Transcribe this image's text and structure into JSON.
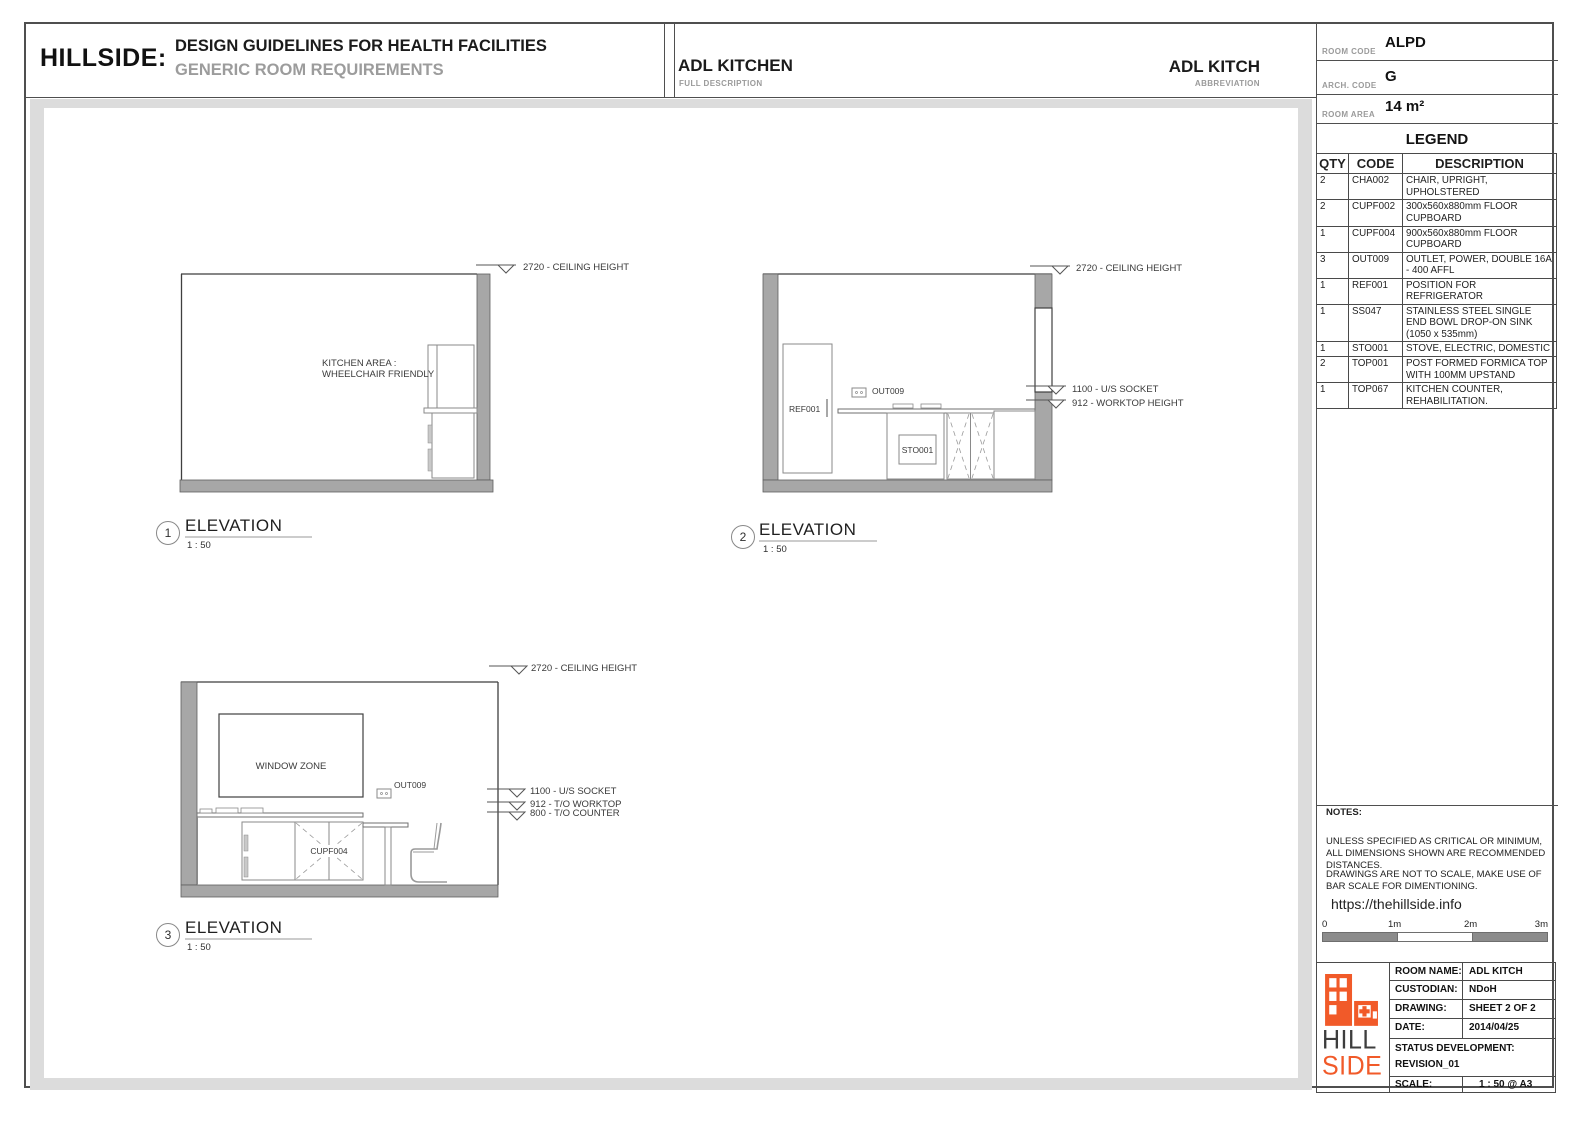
{
  "header": {
    "brand": "HILLSIDE:",
    "title": "DESIGN GUIDELINES FOR HEALTH FACILITIES",
    "subtitle": "GENERIC ROOM REQUIREMENTS",
    "full_description": {
      "value": "ADL KITCHEN",
      "label": "FULL DESCRIPTION"
    },
    "abbreviation": {
      "value": "ADL KITCH",
      "label": "ABBREVIATION"
    }
  },
  "info_panel": {
    "room_code": {
      "label": "ROOM CODE",
      "value": "ALPD"
    },
    "arch_code": {
      "label": "ARCH. CODE",
      "value": "G"
    },
    "room_area": {
      "label": "ROOM AREA",
      "value": "14 m²"
    }
  },
  "legend": {
    "title": "LEGEND",
    "columns": [
      "QTY",
      "CODE",
      "DESCRIPTION"
    ],
    "rows": [
      {
        "qty": "2",
        "code": "CHA002",
        "description": "CHAIR, UPRIGHT, UPHOLSTERED"
      },
      {
        "qty": "2",
        "code": "CUPF002",
        "description": "300x560x880mm FLOOR CUPBOARD"
      },
      {
        "qty": "1",
        "code": "CUPF004",
        "description": "900x560x880mm FLOOR CUPBOARD"
      },
      {
        "qty": "3",
        "code": "OUT009",
        "description": "OUTLET, POWER, DOUBLE 16A - 400 AFFL"
      },
      {
        "qty": "1",
        "code": "REF001",
        "description": "POSITION FOR REFRIGERATOR"
      },
      {
        "qty": "1",
        "code": "SS047",
        "description": "STAINLESS STEEL SINGLE END BOWL  DROP-ON SINK (1050 x 535mm)"
      },
      {
        "qty": "1",
        "code": "STO001",
        "description": "STOVE, ELECTRIC, DOMESTIC"
      },
      {
        "qty": "2",
        "code": "TOP001",
        "description": "POST FORMED FORMICA TOP WITH 100MM UPSTAND"
      },
      {
        "qty": "1",
        "code": "TOP067",
        "description": "KITCHEN COUNTER, REHABILITATION."
      }
    ]
  },
  "elevations": [
    {
      "number": "1",
      "title": "ELEVATION",
      "scale": "1 : 50",
      "annotations": [
        "2720 - CEILING HEIGHT"
      ],
      "notes": {
        "line1": "KITCHEN AREA :",
        "line2": "WHEELCHAIR FRIENDLY"
      }
    },
    {
      "number": "2",
      "title": "ELEVATION",
      "scale": "1 : 50",
      "annotations": [
        "2720 - CEILING HEIGHT",
        "1100 - U/S SOCKET",
        "912 - WORKTOP HEIGHT"
      ],
      "items": {
        "ref": "REF001",
        "outlet": "OUT009",
        "stove": "STO001"
      }
    },
    {
      "number": "3",
      "title": "ELEVATION",
      "scale": "1 : 50",
      "annotations": [
        "2720 - CEILING HEIGHT",
        "1100 - U/S SOCKET",
        "912 - T/O WORKTOP",
        "800 - T/O COUNTER"
      ],
      "items": {
        "window": "WINDOW ZONE",
        "outlet": "OUT009",
        "cupboard": "CUPF004"
      }
    }
  ],
  "notes": {
    "heading": "NOTES:",
    "para1": "UNLESS SPECIFIED AS CRITICAL OR MINIMUM, ALL DIMENSIONS SHOWN ARE RECOMMENDED DISTANCES.",
    "para2": "DRAWINGS ARE NOT TO SCALE, MAKE USE OF BAR SCALE FOR DIMENTIONING.",
    "url": "https://thehillside.info",
    "scale_bar_ticks": [
      "0",
      "1m",
      "2m",
      "3m"
    ]
  },
  "title_block": {
    "logo_word1": "HILL",
    "logo_word2": "SIDE",
    "rows": [
      {
        "label": "ROOM NAME:",
        "value": "ADL KITCH"
      },
      {
        "label": "CUSTODIAN:",
        "value": "NDoH"
      },
      {
        "label": "DRAWING:",
        "value": "SHEET 2 OF 2"
      },
      {
        "label": "DATE:",
        "value": "2014/04/25"
      }
    ],
    "status_label": "STATUS DEVELOPMENT:",
    "status_value": "REVISION_01",
    "scale_label": "SCALE:",
    "scale_value": "1 : 50 @ A3"
  },
  "colors": {
    "accent_orange": "#f15a29",
    "wall_gray": "#a7a7a7",
    "mat_gray": "#dcdcdc"
  }
}
